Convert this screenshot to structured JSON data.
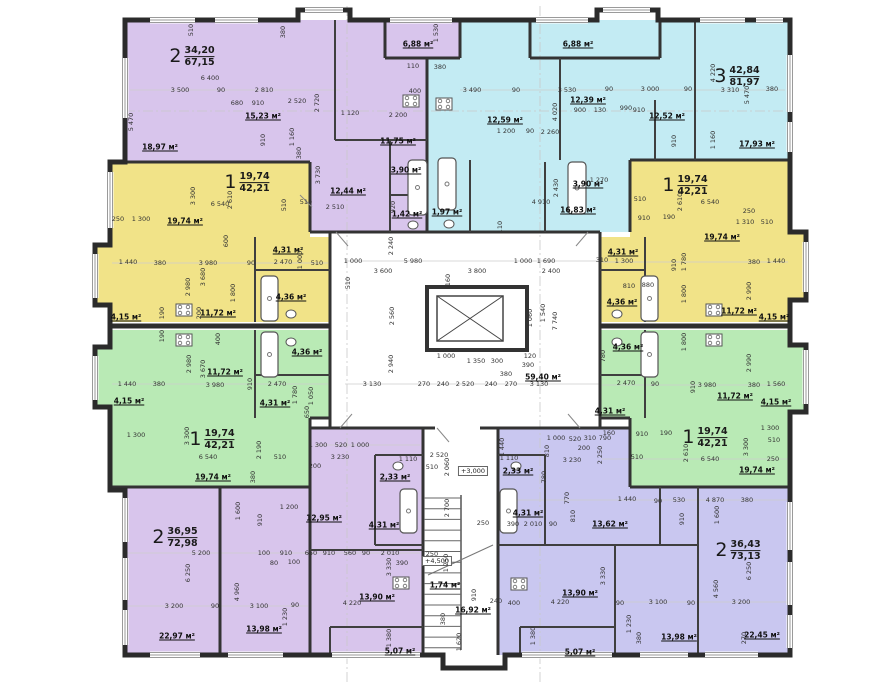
{
  "plan": {
    "colors": {
      "purple": "#d8c5ec",
      "cyan": "#c3ebf3",
      "yellow": "#f1e388",
      "green": "#b9eab5",
      "lavender": "#c9c7f0",
      "wall": "#2e2e2e"
    },
    "apartments": [
      {
        "name": "top-left",
        "rooms_count": "2",
        "living_area": "34,20",
        "total_area": "67,15",
        "color": "#d8c5ec",
        "label_x": 192,
        "label_y": 57
      },
      {
        "name": "top-right",
        "rooms_count": "3",
        "living_area": "42,84",
        "total_area": "81,97",
        "color": "#c3ebf3",
        "label_x": 737,
        "label_y": 77
      },
      {
        "name": "mid-left-yellow",
        "rooms_count": "1",
        "living_area": "19,74",
        "total_area": "42,21",
        "color": "#f1e388",
        "label_x": 247,
        "label_y": 183
      },
      {
        "name": "mid-right-yellow",
        "rooms_count": "1",
        "living_area": "19,74",
        "total_area": "42,21",
        "color": "#f1e388",
        "label_x": 685,
        "label_y": 186
      },
      {
        "name": "mid-left-green",
        "rooms_count": "1",
        "living_area": "19,74",
        "total_area": "42,21",
        "color": "#b9eab5",
        "label_x": 212,
        "label_y": 440
      },
      {
        "name": "mid-right-green",
        "rooms_count": "1",
        "living_area": "19,74",
        "total_area": "42,21",
        "color": "#b9eab5",
        "label_x": 705,
        "label_y": 438
      },
      {
        "name": "bottom-left",
        "rooms_count": "2",
        "living_area": "36,95",
        "total_area": "72,98",
        "color": "#d8c5ec",
        "label_x": 175,
        "label_y": 538
      },
      {
        "name": "bottom-right",
        "rooms_count": "2",
        "living_area": "36,43",
        "total_area": "73,13",
        "color": "#c9c7f0",
        "label_x": 738,
        "label_y": 551
      }
    ],
    "room_labels": [
      [
        "18,97 м²",
        160,
        147
      ],
      [
        "15,23 м²",
        263,
        116
      ],
      [
        "6,88 м²",
        418,
        44
      ],
      [
        "11,75 м²",
        398,
        141
      ],
      [
        "12,44 м²",
        348,
        191
      ],
      [
        "3,90 м²",
        406,
        170
      ],
      [
        "1,42 м²",
        407,
        214
      ],
      [
        "6,88 м²",
        578,
        44
      ],
      [
        "12,59 м²",
        505,
        120
      ],
      [
        "12,39 м²",
        588,
        100
      ],
      [
        "12,52 м²",
        667,
        116
      ],
      [
        "17,93 м²",
        757,
        144
      ],
      [
        "16,83 м²",
        578,
        210
      ],
      [
        "3,90 м²",
        588,
        184
      ],
      [
        "1,97 м²",
        447,
        212
      ],
      [
        "19,74 м²",
        185,
        221
      ],
      [
        "4,31 м²",
        288,
        250
      ],
      [
        "4,36 м²",
        291,
        297
      ],
      [
        "11,72 м²",
        218,
        313
      ],
      [
        "4,15 м²",
        126,
        317
      ],
      [
        "11,72 м²",
        225,
        372
      ],
      [
        "4,36 м²",
        307,
        352
      ],
      [
        "4,31 м²",
        275,
        403
      ],
      [
        "4,15 м²",
        129,
        401
      ],
      [
        "19,74 м²",
        213,
        477
      ],
      [
        "12,95 м²",
        324,
        518
      ],
      [
        "2,33 м²",
        395,
        477
      ],
      [
        "4,31 м²",
        384,
        525
      ],
      [
        "13,90 м²",
        377,
        597
      ],
      [
        "5,07 м²",
        400,
        651
      ],
      [
        "13,98 м²",
        264,
        629
      ],
      [
        "22,97 м²",
        177,
        636
      ],
      [
        "19,74 м²",
        722,
        237
      ],
      [
        "4,31 м²",
        623,
        252
      ],
      [
        "4,36 м²",
        622,
        302
      ],
      [
        "11,72 м²",
        739,
        311
      ],
      [
        "4,15 м²",
        774,
        317
      ],
      [
        "11,72 м²",
        735,
        396
      ],
      [
        "4,36 м²",
        628,
        347
      ],
      [
        "4,31 м²",
        610,
        411
      ],
      [
        "4,15 м²",
        776,
        402
      ],
      [
        "19,74 м²",
        757,
        470
      ],
      [
        "13,62 м²",
        610,
        524
      ],
      [
        "2,33 м²",
        518,
        471
      ],
      [
        "4,31 м²",
        528,
        513
      ],
      [
        "13,90 м²",
        580,
        593
      ],
      [
        "5,07 м²",
        580,
        652
      ],
      [
        "13,98 м²",
        679,
        637
      ],
      [
        "22,45 м²",
        762,
        635
      ],
      [
        "59,40 м²",
        543,
        377
      ],
      [
        "16,92 м²",
        473,
        610
      ],
      [
        "1,74 м²",
        445,
        585
      ]
    ],
    "levels": [
      [
        "+3,000",
        473,
        471
      ],
      [
        "+4,500",
        437,
        561
      ]
    ],
    "dimensions": [
      [
        "3 500",
        180,
        90
      ],
      [
        "90",
        221,
        90
      ],
      [
        "2 810",
        264,
        90
      ],
      [
        "6 400",
        210,
        78
      ],
      [
        "2 520",
        297,
        101
      ],
      [
        "680",
        237,
        103
      ],
      [
        "910",
        258,
        103
      ],
      [
        "1 120",
        350,
        113
      ],
      [
        "2 200",
        398,
        115
      ],
      [
        "5 470",
        131,
        122,
        1
      ],
      [
        "510",
        191,
        30,
        1
      ],
      [
        "380",
        283,
        32,
        1
      ],
      [
        "1 530",
        436,
        33,
        1
      ],
      [
        "110",
        413,
        66
      ],
      [
        "380",
        440,
        67
      ],
      [
        "400",
        415,
        91
      ],
      [
        "2 720",
        317,
        103,
        1
      ],
      [
        "1 160",
        292,
        137,
        1
      ],
      [
        "380",
        299,
        153,
        1
      ],
      [
        "3 730",
        318,
        175,
        1
      ],
      [
        "910",
        263,
        140,
        1
      ],
      [
        "2 510",
        335,
        207
      ],
      [
        "510",
        284,
        205,
        1
      ],
      [
        "920",
        393,
        207,
        1
      ],
      [
        "3 490",
        472,
        90
      ],
      [
        "90",
        516,
        90
      ],
      [
        "3 530",
        567,
        90
      ],
      [
        "90",
        609,
        89
      ],
      [
        "3 000",
        650,
        89
      ],
      [
        "90",
        688,
        89
      ],
      [
        "3 310",
        730,
        90
      ],
      [
        "380",
        772,
        89
      ],
      [
        "4 020",
        555,
        112,
        1
      ],
      [
        "900",
        580,
        110
      ],
      [
        "130",
        600,
        110
      ],
      [
        "990",
        626,
        108
      ],
      [
        "910",
        639,
        110
      ],
      [
        "4 220",
        713,
        73,
        1
      ],
      [
        "5 470",
        747,
        95,
        1
      ],
      [
        "2 260",
        550,
        132
      ],
      [
        "1 200",
        506,
        131
      ],
      [
        "90",
        530,
        131
      ],
      [
        "4 910",
        541,
        202
      ],
      [
        "2 430",
        556,
        188,
        1
      ],
      [
        "1 270",
        599,
        180
      ],
      [
        "1 160",
        713,
        140,
        1
      ],
      [
        "910",
        674,
        141,
        1
      ],
      [
        "1 000",
        353,
        261
      ],
      [
        "5 980",
        413,
        261
      ],
      [
        "1 000",
        523,
        261
      ],
      [
        "1 690",
        546,
        261
      ],
      [
        "3 600",
        383,
        271
      ],
      [
        "3 800",
        477,
        271
      ],
      [
        "2 400",
        551,
        271
      ],
      [
        "2 240",
        391,
        246,
        1
      ],
      [
        "510",
        348,
        283,
        1
      ],
      [
        "2 560",
        392,
        316,
        1
      ],
      [
        "2 940",
        391,
        364,
        1
      ],
      [
        "7 740",
        555,
        321,
        1
      ],
      [
        "1 060",
        530,
        318,
        1
      ],
      [
        "1 540",
        543,
        313,
        1
      ],
      [
        "3 130",
        372,
        384
      ],
      [
        "270",
        424,
        384
      ],
      [
        "240",
        443,
        384
      ],
      [
        "2 520",
        465,
        384
      ],
      [
        "240",
        491,
        384
      ],
      [
        "270",
        511,
        384
      ],
      [
        "3 130",
        539,
        384
      ],
      [
        "1 000",
        446,
        356
      ],
      [
        "1 350",
        476,
        361
      ],
      [
        "300",
        497,
        361
      ],
      [
        "120",
        530,
        356
      ],
      [
        "390",
        528,
        365
      ],
      [
        "380",
        506,
        374
      ],
      [
        "110",
        500,
        227,
        1
      ],
      [
        "160",
        448,
        280,
        1
      ],
      [
        "250",
        118,
        219
      ],
      [
        "1 300",
        141,
        219
      ],
      [
        "6 540",
        220,
        204
      ],
      [
        "510",
        306,
        202
      ],
      [
        "3 300",
        193,
        196,
        1
      ],
      [
        "2 610",
        230,
        200,
        1
      ],
      [
        "1 440",
        128,
        262
      ],
      [
        "380",
        160,
        263
      ],
      [
        "3 980",
        208,
        263
      ],
      [
        "90",
        251,
        263
      ],
      [
        "2 470",
        283,
        262
      ],
      [
        "510",
        317,
        263
      ],
      [
        "2 980",
        188,
        287,
        1
      ],
      [
        "3 680",
        203,
        277,
        1
      ],
      [
        "1 800",
        233,
        293,
        1
      ],
      [
        "1 000",
        300,
        260,
        1
      ],
      [
        "600",
        226,
        241,
        1
      ],
      [
        "190",
        162,
        313,
        1
      ],
      [
        "200",
        199,
        313,
        1
      ],
      [
        "1 440",
        127,
        384
      ],
      [
        "380",
        159,
        384
      ],
      [
        "3 980",
        215,
        385
      ],
      [
        "910",
        250,
        384,
        1
      ],
      [
        "2 470",
        277,
        384
      ],
      [
        "2 980",
        189,
        364,
        1
      ],
      [
        "3 670",
        203,
        369,
        1
      ],
      [
        "1 780",
        295,
        395,
        1
      ],
      [
        "1 050",
        311,
        396,
        1
      ],
      [
        "650",
        307,
        412,
        1
      ],
      [
        "1 300",
        136,
        435
      ],
      [
        "3 300",
        187,
        436,
        1
      ],
      [
        "6 540",
        208,
        457
      ],
      [
        "510",
        280,
        457
      ],
      [
        "2 190",
        259,
        450,
        1
      ],
      [
        "380",
        253,
        477,
        1
      ],
      [
        "190",
        162,
        336,
        1
      ],
      [
        "400",
        218,
        339,
        1
      ],
      [
        "1 300",
        318,
        445
      ],
      [
        "520",
        341,
        445
      ],
      [
        "1 000",
        360,
        445
      ],
      [
        "3 230",
        340,
        457
      ],
      [
        "200",
        315,
        466
      ],
      [
        "1 200",
        289,
        507
      ],
      [
        "1 600",
        238,
        511,
        1
      ],
      [
        "910",
        260,
        520,
        1
      ],
      [
        "5 200",
        201,
        553
      ],
      [
        "100",
        264,
        553
      ],
      [
        "910",
        286,
        553
      ],
      [
        "80",
        274,
        563
      ],
      [
        "100",
        294,
        562
      ],
      [
        "650",
        311,
        553
      ],
      [
        "910",
        329,
        553
      ],
      [
        "560",
        350,
        553
      ],
      [
        "90",
        366,
        553
      ],
      [
        "2 010",
        390,
        553
      ],
      [
        "6 250",
        188,
        573,
        1
      ],
      [
        "3 200",
        174,
        606
      ],
      [
        "90",
        215,
        606
      ],
      [
        "3 100",
        259,
        606
      ],
      [
        "90",
        295,
        605
      ],
      [
        "4 960",
        237,
        592,
        1
      ],
      [
        "4 220",
        352,
        603
      ],
      [
        "3 330",
        389,
        567,
        1
      ],
      [
        "390",
        402,
        563
      ],
      [
        "1 230",
        285,
        617,
        1
      ],
      [
        "1 380",
        389,
        638,
        1
      ],
      [
        "2 520",
        439,
        455
      ],
      [
        "510",
        432,
        467
      ],
      [
        "2 060",
        447,
        467,
        1
      ],
      [
        "2 700",
        447,
        508,
        1
      ],
      [
        "250",
        483,
        523
      ],
      [
        "1 250",
        446,
        563,
        1
      ],
      [
        "250",
        432,
        554
      ],
      [
        "910",
        474,
        595,
        1
      ],
      [
        "380",
        443,
        619,
        1
      ],
      [
        "1 620",
        459,
        642,
        1
      ],
      [
        "1 110",
        408,
        459
      ],
      [
        "1 310",
        745,
        222
      ],
      [
        "510",
        767,
        222
      ],
      [
        "250",
        749,
        211
      ],
      [
        "6 540",
        710,
        202
      ],
      [
        "510",
        640,
        199
      ],
      [
        "2 610",
        680,
        202,
        1
      ],
      [
        "910",
        644,
        218
      ],
      [
        "190",
        669,
        217
      ],
      [
        "1 780",
        684,
        262,
        1
      ],
      [
        "910",
        674,
        265,
        1
      ],
      [
        "1 800",
        684,
        294,
        1
      ],
      [
        "380",
        754,
        262
      ],
      [
        "1 440",
        776,
        261
      ],
      [
        "2 990",
        749,
        291,
        1
      ],
      [
        "310",
        602,
        260
      ],
      [
        "1 300",
        624,
        261
      ],
      [
        "810",
        629,
        286
      ],
      [
        "880",
        648,
        285
      ],
      [
        "2 470",
        626,
        383
      ],
      [
        "90",
        655,
        384
      ],
      [
        "910",
        693,
        387,
        1
      ],
      [
        "3 980",
        707,
        385
      ],
      [
        "380",
        754,
        385
      ],
      [
        "1 560",
        776,
        384
      ],
      [
        "1 800",
        684,
        342,
        1
      ],
      [
        "2 990",
        749,
        363,
        1
      ],
      [
        "780",
        603,
        356,
        1
      ],
      [
        "1 300",
        770,
        428
      ],
      [
        "510",
        774,
        440
      ],
      [
        "6 540",
        710,
        459
      ],
      [
        "510",
        637,
        457
      ],
      [
        "250",
        773,
        459
      ],
      [
        "2 610",
        686,
        453,
        1
      ],
      [
        "3 300",
        746,
        447,
        1
      ],
      [
        "910",
        642,
        434
      ],
      [
        "190",
        666,
        433
      ],
      [
        "160",
        609,
        433
      ],
      [
        "1 000",
        556,
        438
      ],
      [
        "520",
        575,
        439
      ],
      [
        "310",
        590,
        438
      ],
      [
        "790",
        605,
        438
      ],
      [
        "3 230",
        572,
        460
      ],
      [
        "200",
        584,
        448
      ],
      [
        "2 250",
        600,
        455,
        1
      ],
      [
        "1 110",
        509,
        458
      ],
      [
        "1 440",
        502,
        447,
        1
      ],
      [
        "810",
        547,
        451,
        1
      ],
      [
        "780",
        544,
        477,
        1
      ],
      [
        "770",
        567,
        498,
        1
      ],
      [
        "810",
        573,
        516,
        1
      ],
      [
        "390",
        513,
        524
      ],
      [
        "2 010",
        533,
        524
      ],
      [
        "90",
        553,
        524
      ],
      [
        "1 440",
        627,
        499
      ],
      [
        "90",
        658,
        501
      ],
      [
        "530",
        679,
        500
      ],
      [
        "4 870",
        715,
        500
      ],
      [
        "380",
        747,
        500
      ],
      [
        "1 600",
        717,
        515,
        1
      ],
      [
        "910",
        682,
        519,
        1
      ],
      [
        "3 330",
        603,
        576,
        1
      ],
      [
        "4 220",
        560,
        602
      ],
      [
        "400",
        514,
        603
      ],
      [
        "240",
        496,
        601
      ],
      [
        "6 250",
        749,
        571,
        1
      ],
      [
        "4 560",
        716,
        589,
        1
      ],
      [
        "3 100",
        658,
        602
      ],
      [
        "90",
        620,
        603
      ],
      [
        "90",
        691,
        603
      ],
      [
        "3 200",
        741,
        602
      ],
      [
        "1 230",
        629,
        624,
        1
      ],
      [
        "380",
        639,
        638,
        1
      ],
      [
        "270",
        744,
        638,
        1
      ],
      [
        "1 380",
        533,
        636,
        1
      ]
    ]
  }
}
